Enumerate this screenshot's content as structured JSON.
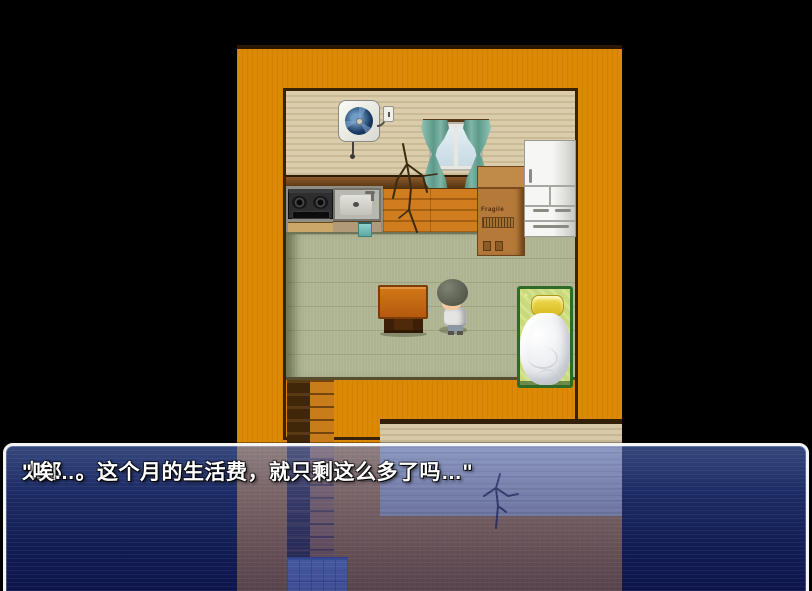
{
  "dialog": {
    "speaker": "太郎",
    "message": "\"唉…。这个月的生活费，就只剩这么多了吗…\""
  },
  "labels": {
    "box_label": "Fragile"
  },
  "scene": {
    "objects": [
      "ventilation-fan-icon",
      "power-outlet-icon",
      "curtained-window",
      "wall-crack",
      "gas-stove",
      "kitchen-sink",
      "hand-towel",
      "wooden-plank-floor",
      "cardboard-box",
      "refrigerator",
      "tatami-floor",
      "low-table",
      "player-character",
      "bed-with-pillow-and-blanket",
      "exterior-ladder",
      "lower-wall-crack",
      "blue-floor-tiles"
    ]
  },
  "colors": {
    "background": "#000000",
    "building_orange": "#dc8905",
    "interior_wall_beige": "#d8caa8",
    "tatami_green": "#aeb391",
    "curtain_teal": "#74ad9d",
    "bed_frame_green": "#2e6b28",
    "pillow_yellow": "#e8d437",
    "message_window_blue": "#2943af",
    "message_border": "#f4f4f4",
    "text": "#ffffff"
  }
}
